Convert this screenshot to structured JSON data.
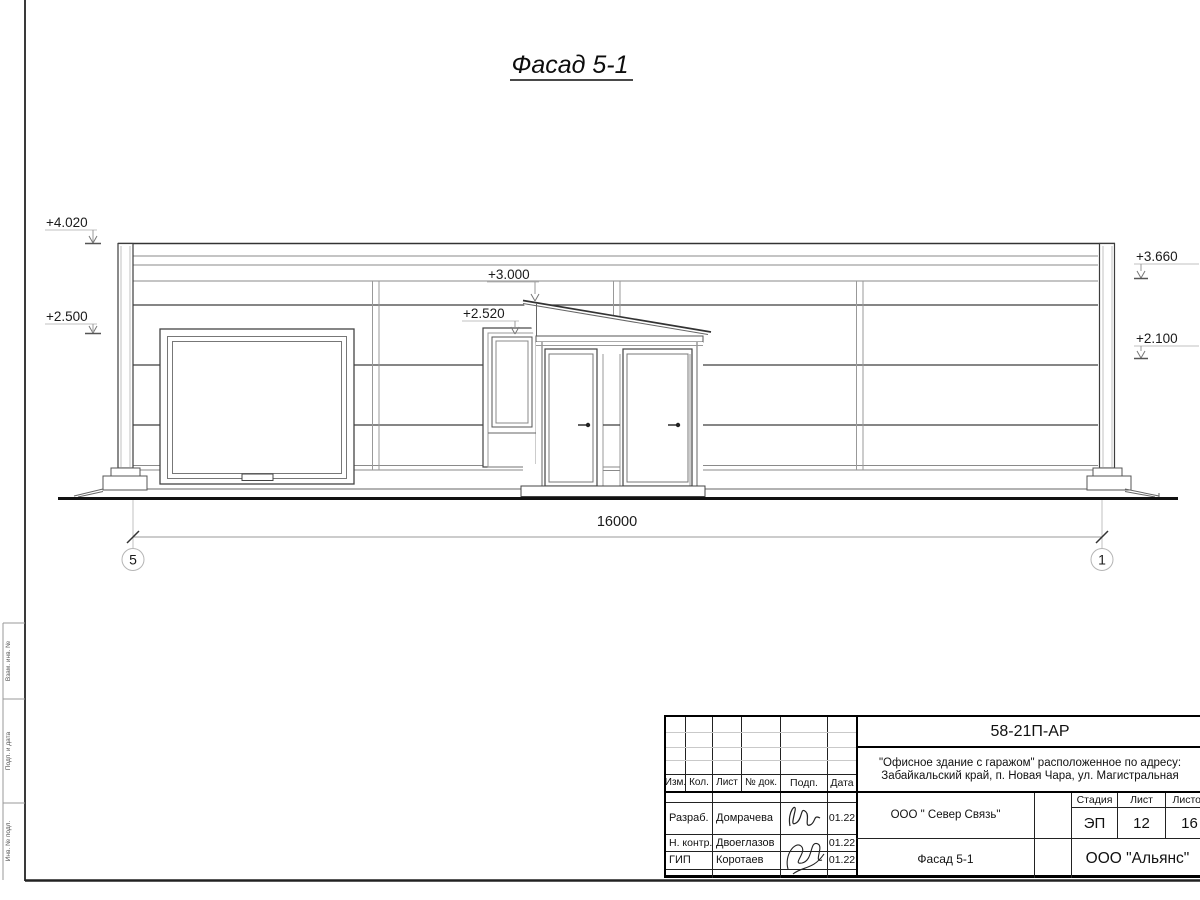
{
  "drawing": {
    "title": "Фасад 5-1",
    "dimension_total": "16000",
    "axes": [
      {
        "label": "5"
      },
      {
        "label": "1"
      }
    ],
    "elevations": [
      {
        "value": "+4.020"
      },
      {
        "value": "+2.500"
      },
      {
        "value": "+3.000"
      },
      {
        "value": "+2.520"
      },
      {
        "value": "+3.660"
      },
      {
        "value": "+2.100"
      }
    ]
  },
  "margin": {
    "labels": [
      {
        "text": "Взам. инв. №"
      },
      {
        "text": "Подп. и дата"
      },
      {
        "text": "Инв. № подл."
      }
    ]
  },
  "titleblock": {
    "doc_code": "58-21П-АР",
    "project_line1": "\"Офисное здание с гаражом\" расположенное по адресу:",
    "project_line2": "Забайкальский край, п. Новая Чара, ул. Магистральная",
    "columns": {
      "izm": "Изм.",
      "kol": "Кол.",
      "list": "Лист",
      "doc": "№ док.",
      "podp": "Подп.",
      "data": "Дата"
    },
    "rows": [
      {
        "role": "Разраб.",
        "name": "Домрачева",
        "date": "01.22"
      },
      {
        "role": "Н. контр.",
        "name": "Двоеглазов",
        "date": "01.22"
      },
      {
        "role": "ГИП",
        "name": "Коротаев",
        "date": "01.22"
      }
    ],
    "client": "ООО \" Север Связь\"",
    "stage_label": "Стадия",
    "sheet_label": "Лист",
    "sheets_label": "Листов",
    "stage": "ЭП",
    "sheet_number": "12",
    "sheets_total": "16",
    "drawing_name": "Фасад 5-1",
    "company": "ООО \"Альянс\""
  }
}
